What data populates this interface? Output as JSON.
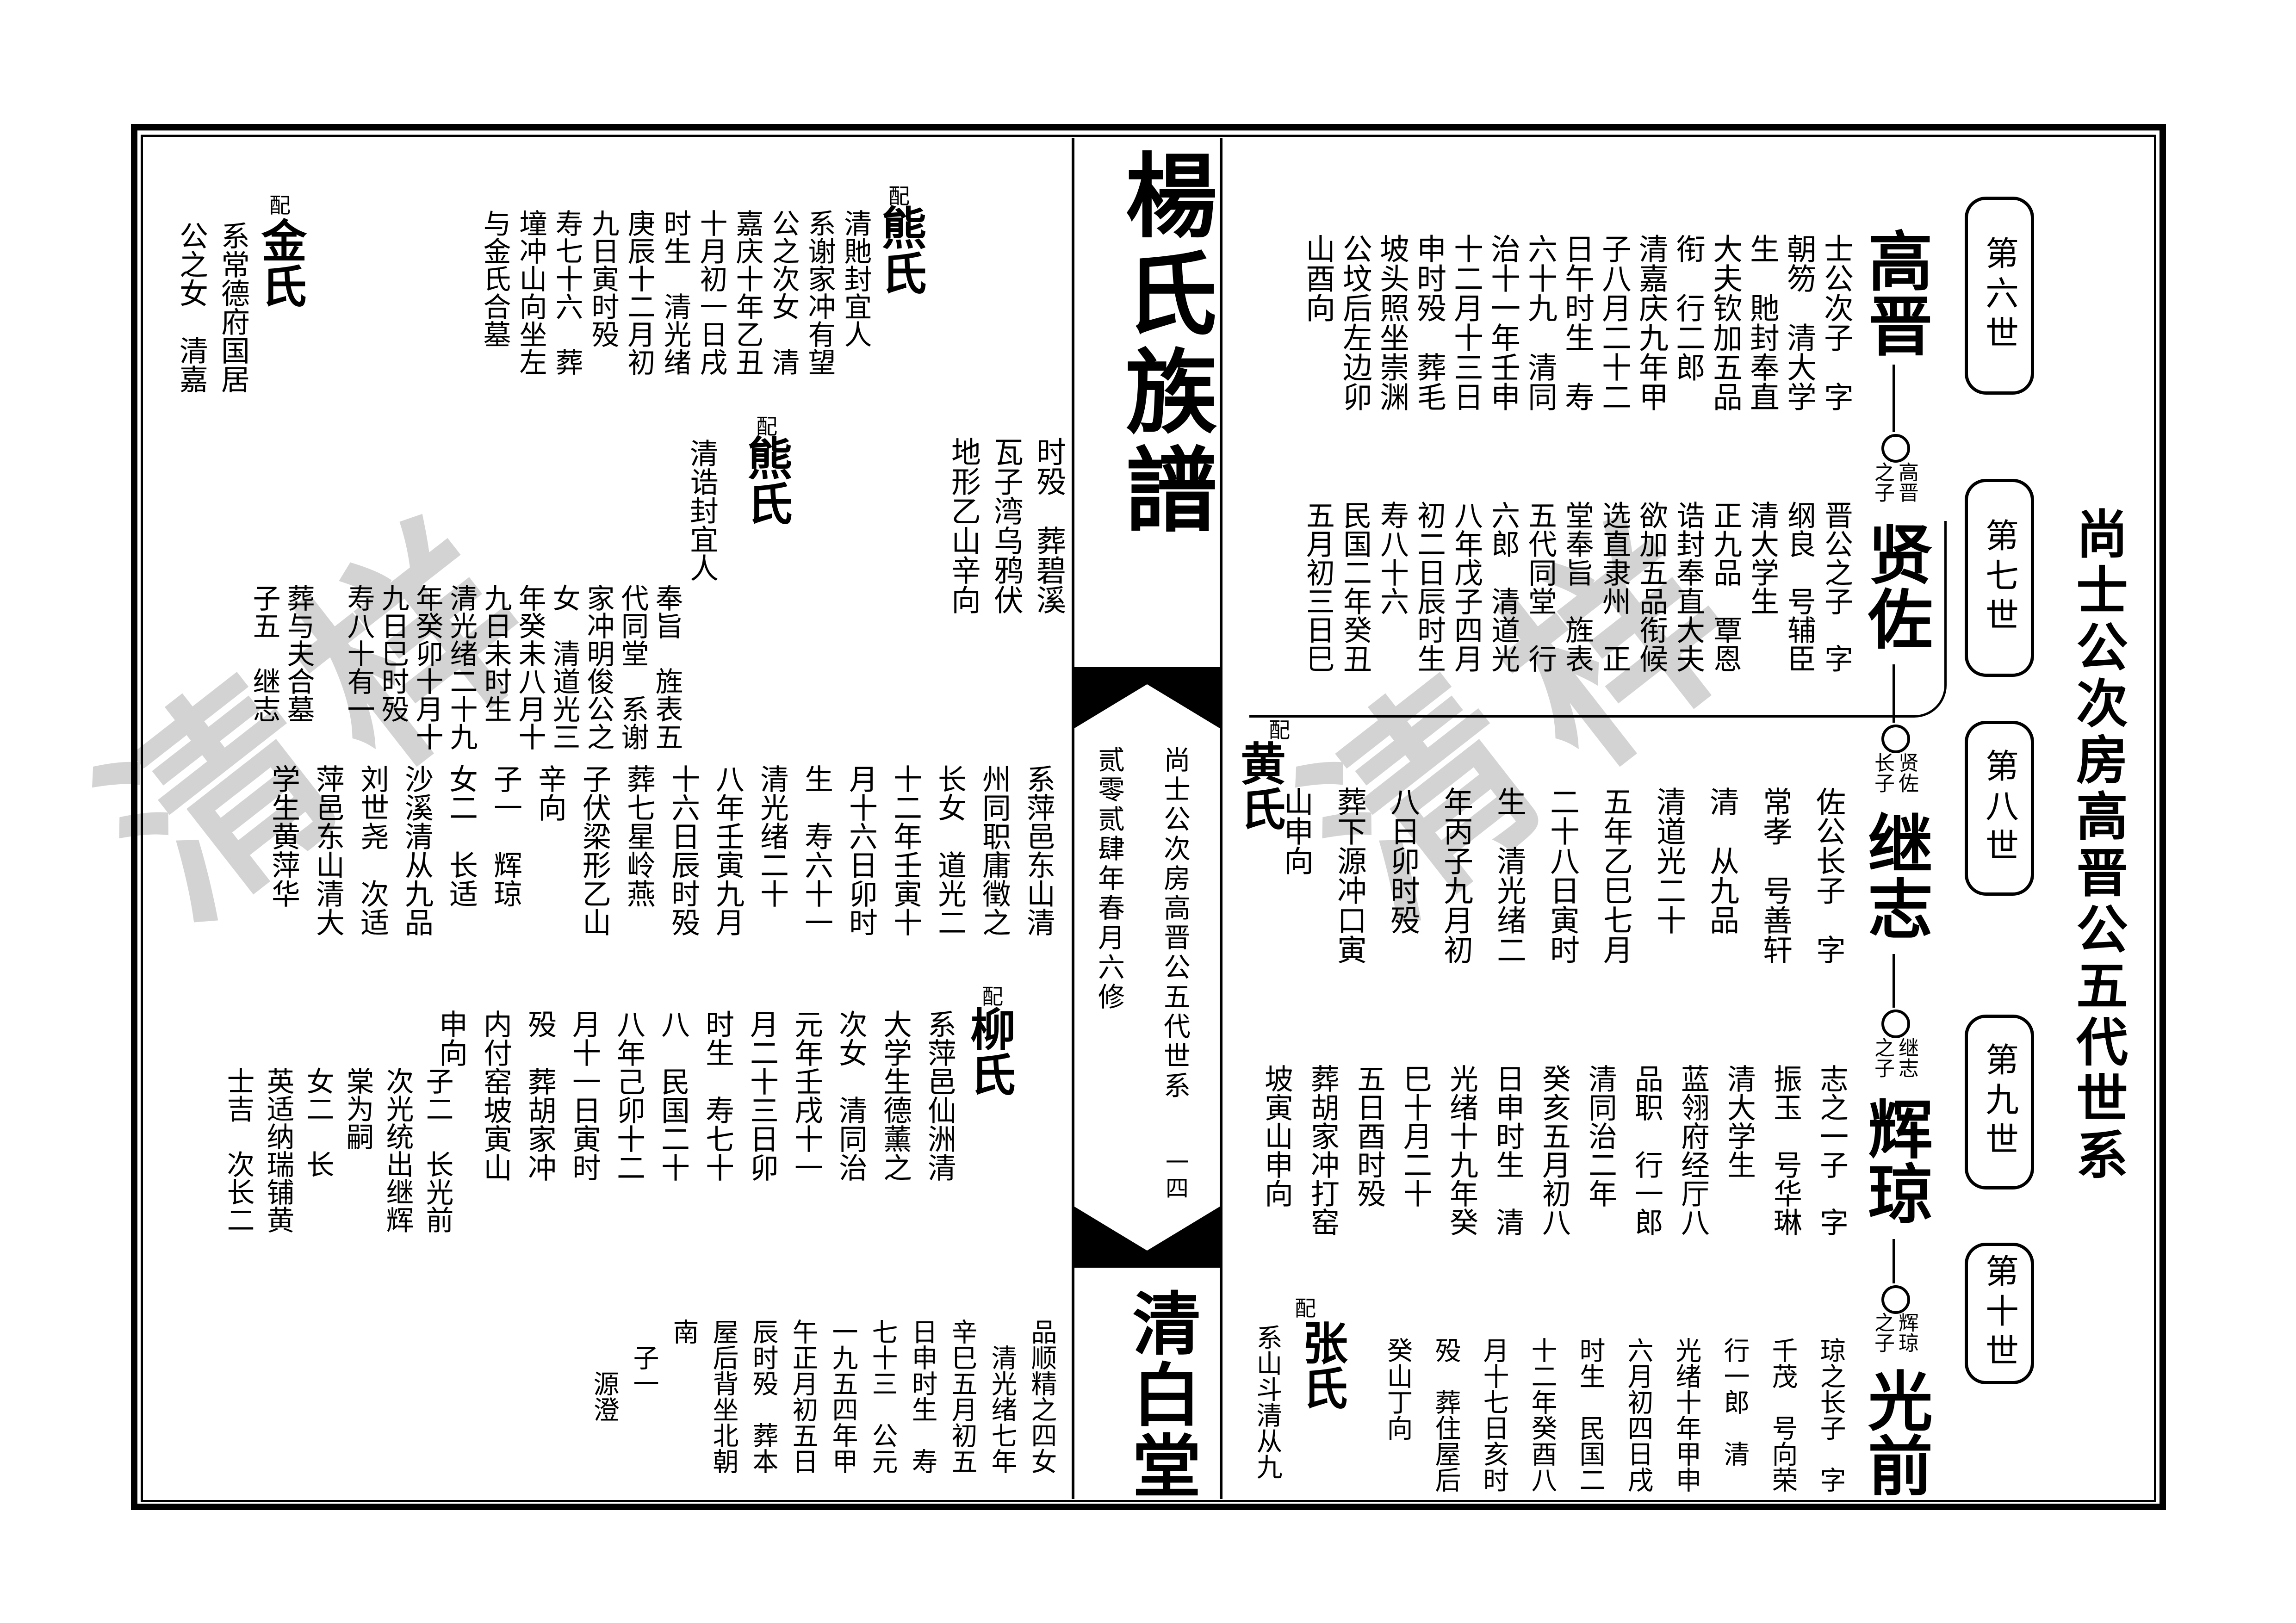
{
  "page": {
    "book_title": "楊氏族譜",
    "hall_name": "清白堂",
    "side_title": "尚士公次房高晋公五代世系",
    "spine_section_title": "尚士公次房高晋公五代世系",
    "spine_edition": "贰零贰肆年春月六修",
    "page_number": "一四",
    "pei_label": "配",
    "watermark_glyphs": "清样",
    "ink_color": "#000000",
    "paper_color": "#ffffff",
    "watermark_color": "#c9c9c9"
  },
  "generations": [
    {
      "label": "第六世"
    },
    {
      "label": "第七世"
    },
    {
      "label": "第八世"
    },
    {
      "label": "第九世"
    },
    {
      "label": "第十世"
    }
  ],
  "lineage": {
    "nodes": [
      {
        "name": "高晋",
        "link_label": "高晋之子"
      },
      {
        "name": "贤佐",
        "link_label": "贤佐长子"
      },
      {
        "name": "继志",
        "link_label": "继志之子"
      },
      {
        "name": "辉琼",
        "link_label": "辉琼之子"
      },
      {
        "name": "光前",
        "link_label": ""
      }
    ],
    "entries": {
      "gaojin": [
        "士公次子　字",
        "朝笏　清大学",
        "生　貤封奉直",
        "大夫钦加五品",
        "衔　行二郎",
        "清嘉庆九年甲",
        "子八月二十二",
        "日午时生　寿",
        "六十九　清同",
        "治十一年壬申",
        "十二月十三日",
        "申时殁　葬毛",
        "坡头照坐崇渊",
        "公坟后左边卯",
        "山酉向"
      ],
      "xianzuo": [
        "晋公之子　字",
        "纲良　号辅臣",
        "清大学生",
        "正九品　覃恩",
        "诰封奉直大夫",
        "欲加五品衔候",
        "选直隶州　正",
        "堂奉旨　旌表",
        "五代同堂　行",
        "六郎　清道光",
        "八年戊子四月",
        "初二日辰时生",
        "寿八十六",
        "民国二年癸丑",
        "五月初三日巳"
      ],
      "jizhi": [
        "佐公长子　字",
        "常孝　号善轩",
        "清　从九品",
        "清道光二十",
        "五年乙巳七月",
        "二十八日寅时",
        "生　清光绪二",
        "年丙子九月初",
        "八日卯时殁",
        "葬下源冲口寅",
        "山申向"
      ],
      "huiqiong": [
        "志之一子　字",
        "振玉　号华琳",
        "清大学生",
        "蓝翎府经厅八",
        "品职　行一郎",
        "清同治二年",
        "癸亥五月初八",
        "日申时生　清",
        "光绪十九年癸",
        "巳十月二十",
        "五日酉时殁",
        "葬胡家冲打窑",
        "坡寅山申向"
      ],
      "guangqian": [
        "琼之长子　字",
        "千茂　号向荣",
        "行一郎　清",
        "光绪十年甲申",
        "六月初四日戌",
        "时生　民国二",
        "十二年癸酉八",
        "月十七日亥时",
        "殁　葬住屋后",
        "癸山丁向"
      ]
    }
  },
  "spouses": {
    "huang": {
      "name": "黄氏"
    },
    "zhang": {
      "name": "张氏",
      "columns": [
        "系山斗清从九"
      ]
    },
    "xiong1": {
      "name": "熊氏",
      "columns": [
        "清貤封宜人",
        "系谢家冲有望",
        "公之次女　清",
        "嘉庆十年乙丑",
        "十月初一日戌",
        "时生　清光绪",
        "庚辰十二月初",
        "九日寅时殁",
        "寿七十六　葬",
        "墥冲山向坐左",
        "与金氏合墓"
      ]
    },
    "jin": {
      "name": "金氏",
      "columns": [
        "系常德府国居",
        "公之女　清嘉"
      ],
      "tail": [
        "葬与夫合墓",
        "子五　继志"
      ]
    },
    "xiong2": {
      "name": "熊氏",
      "columns": [
        "清诰封宜人"
      ],
      "tail": [
        "奉旨　旌表五",
        "代同堂　系谢",
        "家冲明俊公之",
        "女　清道光三",
        "年癸未八月十",
        "九日未时生",
        "清光绪二十九",
        "年癸卯十月十",
        "九日巳时殁",
        "寿八十有一"
      ]
    },
    "liu": {
      "name": "柳氏",
      "columns": [
        "系萍邑仙洲清",
        "大学生德薰之",
        "次女　清同治",
        "元年壬戌十一",
        "月二十三日卯",
        "时生　寿七十",
        "八　民国二十",
        "八年己卯十二",
        "月十一日寅时",
        "殁　葬胡家冲",
        "内付窑坡寅山",
        "申向"
      ],
      "children": [
        "子二　长光前",
        "次光统出继辉",
        "棠为嗣",
        "女二　长",
        "英适纳瑞铺黄",
        "士吉　次长二"
      ]
    }
  },
  "left_page_blocks": {
    "burial_note": [
      "时殁　葬碧溪",
      "瓦子湾乌鸦伏",
      "地形乙山辛向"
    ],
    "huang_detail": [
      "系萍邑东山清",
      "州同职庸徵之",
      "长女　道光二",
      "十二年壬寅十",
      "月十六日卯时",
      "生　寿六十一",
      "清光绪二十",
      "八年壬寅九月",
      "十六日辰时殁",
      "葬七星岭燕",
      "子伏梁形乙山",
      "辛向",
      "子一　辉琼",
      "女二　长适",
      "沙溪清从九品",
      "刘世尧　次适",
      "萍邑东山清大",
      "学生黄萍华"
    ],
    "zhang_detail": [
      "品顺精之四女",
      "　清光绪七年",
      "辛巳五月初五",
      "日申时生　寿",
      "七十三　公元",
      "一九五四年甲",
      "午正月初五日",
      "辰时殁　葬本",
      "屋后背坐北朝",
      "南",
      "　子一",
      "　　源澄"
    ]
  }
}
